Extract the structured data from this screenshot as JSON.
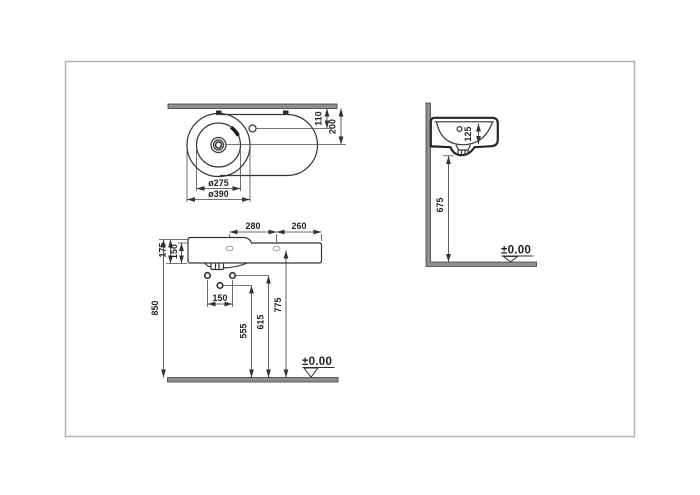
{
  "colors": {
    "line": "#343434",
    "wall_fill": "#8f8f8f",
    "text": "#1f1f1f",
    "frame": "#b3b3b3"
  },
  "views": {
    "plan": {
      "dims": {
        "tap_offset": "110",
        "drain_offset": "200",
        "inner_diameter": "ø275",
        "outer_diameter": "ø390"
      }
    },
    "front": {
      "dims": {
        "span_left": "280",
        "span_right": "260",
        "height_rim": "175",
        "height_body": "150",
        "height_overall": "850",
        "anchor_spacing": "150",
        "anchor_low": "555",
        "anchor_high": "615",
        "fixing_hole": "775"
      },
      "level": "±0.00"
    },
    "side": {
      "dims": {
        "bowl_depth": "125",
        "clearance": "675"
      },
      "level": "±0.00"
    }
  }
}
